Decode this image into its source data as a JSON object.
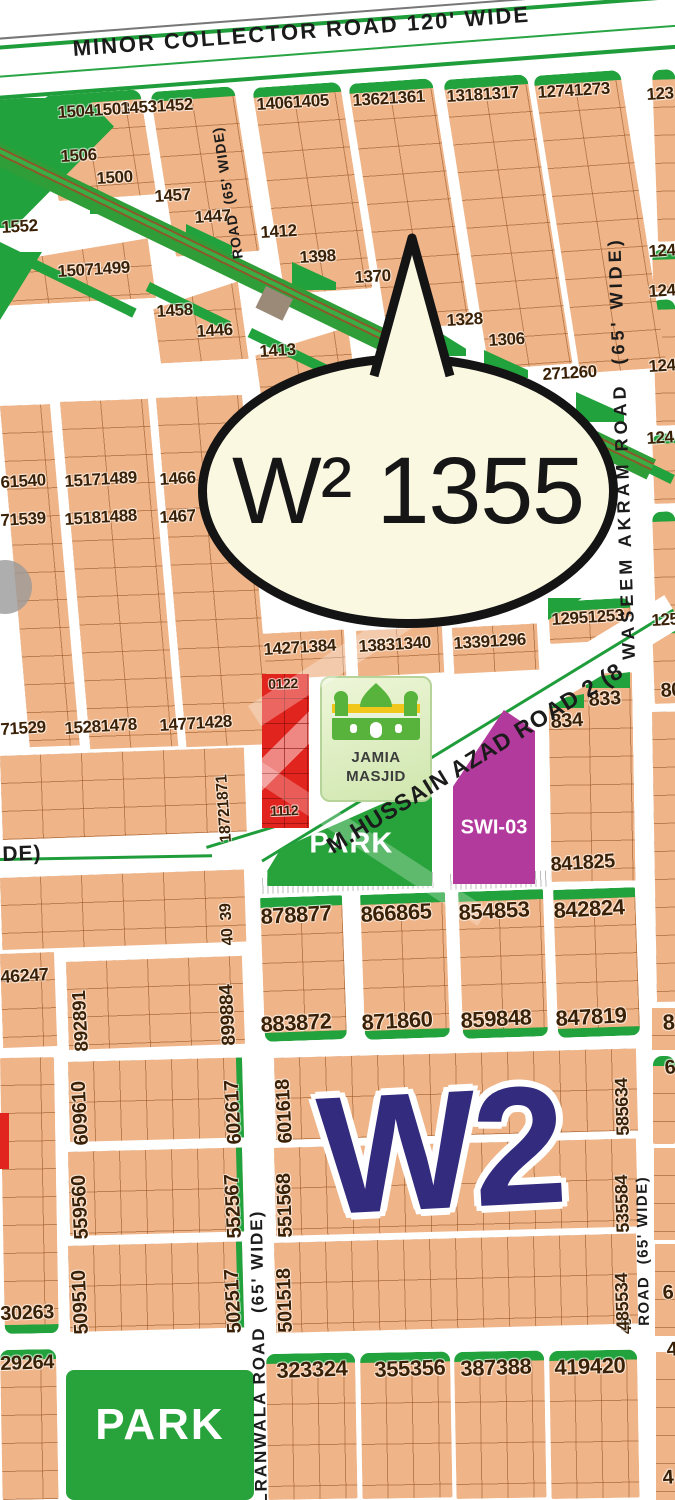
{
  "bubble": {
    "label": "W² 1355"
  },
  "district_logo": "W2",
  "roads": {
    "minor_collector": "MINOR COLLECTOR ROAD 120' WIDE",
    "road_65_top": "ROAD  (65' WIDE)",
    "waseem_akram": "WASEEM AKRAM ROAD  (65' WIDE)",
    "hussain_azad": "M.HUSSAIN AZAD ROAD 2 (8",
    "gujranwala_partial": "LRANWALA ROAD  (65' WIDE)",
    "road_65_bottom": "ROAD  (65' WIDE)",
    "wide_partial": "DE)",
    "road_48_partial": "48"
  },
  "landmarks": {
    "masjid_line1": "JAMIA",
    "masjid_line2": "MASJID",
    "park_mid": "PARK",
    "park_bottom": "PARK",
    "swi": "SWI-03"
  },
  "colors": {
    "plot_tan": "#efb488",
    "green": "#22a23c",
    "bubble_cream": "#fbf8e2",
    "logo_navy": "#322b7e",
    "swi_magenta": "#b23a9c",
    "commercial_red": "#e2241e",
    "number_brown": "#3a2106"
  },
  "plots": [
    {
      "t": "15041503",
      "x": 57,
      "y": 104
    },
    {
      "t": "1506",
      "x": 60,
      "y": 148
    },
    {
      "t": "1500",
      "x": 96,
      "y": 170
    },
    {
      "t": "14531452",
      "x": 120,
      "y": 100
    },
    {
      "t": "1457",
      "x": 154,
      "y": 188
    },
    {
      "t": "1447",
      "x": 194,
      "y": 209
    },
    {
      "t": "14061405",
      "x": 256,
      "y": 96
    },
    {
      "t": "1412",
      "x": 260,
      "y": 224
    },
    {
      "t": "1398",
      "x": 299,
      "y": 249
    },
    {
      "t": "13621361",
      "x": 352,
      "y": 92
    },
    {
      "t": "1370",
      "x": 354,
      "y": 269
    },
    {
      "t": "13181317",
      "x": 446,
      "y": 88
    },
    {
      "t": "1328",
      "x": 446,
      "y": 312
    },
    {
      "t": "1306",
      "x": 488,
      "y": 332
    },
    {
      "t": "12741273",
      "x": 537,
      "y": 84
    },
    {
      "t": "123",
      "x": 646,
      "y": 86
    },
    {
      "t": "1552",
      "x": 1,
      "y": 219
    },
    {
      "t": "15071499",
      "x": 57,
      "y": 263
    },
    {
      "t": "1458",
      "x": 156,
      "y": 303
    },
    {
      "t": "1446",
      "x": 196,
      "y": 323
    },
    {
      "t": "1413",
      "x": 259,
      "y": 343
    },
    {
      "t": "271260",
      "x": 542,
      "y": 366
    },
    {
      "t": "124",
      "x": 648,
      "y": 243
    },
    {
      "t": "124",
      "x": 648,
      "y": 283
    },
    {
      "t": "124",
      "x": 648,
      "y": 358
    },
    {
      "t": "124",
      "x": 646,
      "y": 430
    },
    {
      "t": "125",
      "x": 651,
      "y": 612
    },
    {
      "t": "61540",
      "x": 0,
      "y": 474
    },
    {
      "t": "15171489",
      "x": 64,
      "y": 473
    },
    {
      "t": "1466",
      "x": 159,
      "y": 471
    },
    {
      "t": "71539",
      "x": 0,
      "y": 512
    },
    {
      "t": "15181488",
      "x": 64,
      "y": 511
    },
    {
      "t": "1467",
      "x": 159,
      "y": 509
    },
    {
      "t": "71529",
      "x": 0,
      "y": 721
    },
    {
      "t": "15281478",
      "x": 64,
      "y": 720
    },
    {
      "t": "14771428",
      "x": 159,
      "y": 717
    },
    {
      "t": "14271384",
      "x": 263,
      "y": 641
    },
    {
      "t": "13831340",
      "x": 358,
      "y": 638
    },
    {
      "t": "13391296",
      "x": 453,
      "y": 635
    },
    {
      "t": "12951253",
      "x": 551,
      "y": 611
    },
    {
      "t": "833",
      "x": 588,
      "y": 690,
      "s": 20
    },
    {
      "t": "834",
      "x": 550,
      "y": 712,
      "s": 20
    },
    {
      "t": "80",
      "x": 660,
      "y": 681,
      "s": 20
    },
    {
      "t": "841825",
      "x": 550,
      "y": 855,
      "s": 20
    },
    {
      "t": "0122",
      "x": 268,
      "y": 677,
      "s": 14,
      "r": -2
    },
    {
      "t": "1112",
      "x": 270,
      "y": 804,
      "s": 14,
      "r": -2
    },
    {
      "t": "878877",
      "x": 260,
      "y": 906,
      "s": 22,
      "r": -3
    },
    {
      "t": "866865",
      "x": 360,
      "y": 904,
      "s": 22,
      "r": -3
    },
    {
      "t": "854853",
      "x": 458,
      "y": 902,
      "s": 22,
      "r": -3
    },
    {
      "t": "842824",
      "x": 553,
      "y": 900,
      "s": 22,
      "r": -3
    },
    {
      "t": "883872",
      "x": 260,
      "y": 1014,
      "s": 22,
      "r": -3
    },
    {
      "t": "871860",
      "x": 361,
      "y": 1012,
      "s": 22,
      "r": -3
    },
    {
      "t": "859848",
      "x": 460,
      "y": 1010,
      "s": 22,
      "r": -3
    },
    {
      "t": "847819",
      "x": 555,
      "y": 1008,
      "s": 22,
      "r": -3
    },
    {
      "t": "8",
      "x": 662,
      "y": 1012,
      "s": 22
    },
    {
      "t": "46247",
      "x": 0,
      "y": 968,
      "s": 18
    },
    {
      "t": "30263",
      "x": 0,
      "y": 1304,
      "s": 20,
      "r": -2
    },
    {
      "t": "29264",
      "x": 0,
      "y": 1354,
      "s": 20,
      "r": -2
    },
    {
      "t": "323324",
      "x": 276,
      "y": 1360,
      "s": 22,
      "r": -2
    },
    {
      "t": "355356",
      "x": 374,
      "y": 1359,
      "s": 22,
      "r": -2
    },
    {
      "t": "387388",
      "x": 460,
      "y": 1358,
      "s": 22,
      "r": -2
    },
    {
      "t": "419420",
      "x": 554,
      "y": 1357,
      "s": 22,
      "r": -2
    },
    {
      "t": "6",
      "x": 664,
      "y": 1058,
      "s": 20
    },
    {
      "t": "6",
      "x": 662,
      "y": 1283,
      "s": 20
    },
    {
      "t": "4",
      "x": 666,
      "y": 1340,
      "s": 20
    },
    {
      "t": "4",
      "x": 662,
      "y": 1468,
      "s": 20
    },
    {
      "t": "18721871",
      "x": 219,
      "y": 843,
      "r": -94,
      "s": 16
    },
    {
      "t": "40  39",
      "x": 221,
      "y": 946,
      "r": -94,
      "s": 16
    },
    {
      "t": "899884",
      "x": 220,
      "y": 1046,
      "r": -93,
      "s": 19
    },
    {
      "t": "892891",
      "x": 73,
      "y": 1052,
      "r": -93,
      "s": 19
    },
    {
      "t": "609610",
      "x": 72,
      "y": 1146,
      "r": -93,
      "s": 20
    },
    {
      "t": "602617",
      "x": 225,
      "y": 1145,
      "r": -93,
      "s": 20
    },
    {
      "t": "601618",
      "x": 276,
      "y": 1144,
      "r": -93,
      "s": 20
    },
    {
      "t": "585634",
      "x": 614,
      "y": 1136,
      "r": -92,
      "s": 18
    },
    {
      "t": "559560",
      "x": 72,
      "y": 1240,
      "r": -93,
      "s": 20
    },
    {
      "t": "552567",
      "x": 225,
      "y": 1239,
      "r": -93,
      "s": 20
    },
    {
      "t": "551568",
      "x": 276,
      "y": 1238,
      "r": -92,
      "s": 20
    },
    {
      "t": "535584",
      "x": 614,
      "y": 1233,
      "r": -92,
      "s": 18
    },
    {
      "t": "509510",
      "x": 72,
      "y": 1335,
      "r": -93,
      "s": 20
    },
    {
      "t": "502517",
      "x": 225,
      "y": 1334,
      "r": -93,
      "s": 20
    },
    {
      "t": "501518",
      "x": 276,
      "y": 1333,
      "r": -92,
      "s": 20
    },
    {
      "t": "485534",
      "x": 614,
      "y": 1331,
      "r": -92,
      "s": 18
    }
  ]
}
